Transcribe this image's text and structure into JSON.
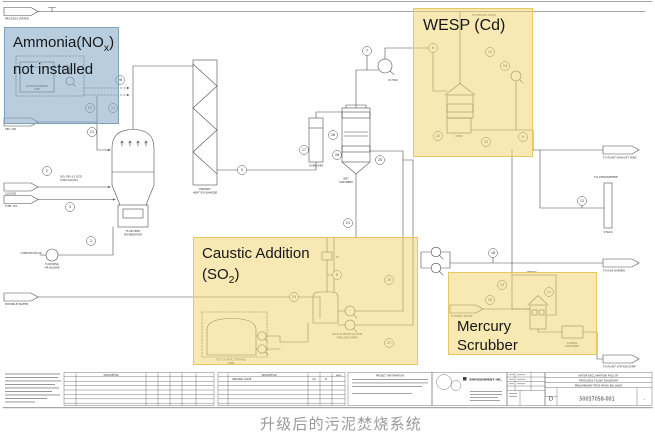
{
  "page": {
    "caption": "升级后的污泥焚烧系统"
  },
  "colors": {
    "highlight_blue": "#7da4c2",
    "highlight_blue_border": "#7fa2bb",
    "highlight_yellow": "#f2d369",
    "highlight_yellow_border": "#e7c763",
    "line": "#4f4f4f"
  },
  "overlays": {
    "ammonia": {
      "line1_main": "Ammonia(NO",
      "line1_sub": "x",
      "line1_close": ")",
      "line2": "not installed"
    },
    "wesp": {
      "label": "WESP (Cd)"
    },
    "caustic": {
      "line1": "Caustic Addition",
      "line2_main": "(SO",
      "line2_sub": "2",
      "line2_close": ")"
    },
    "mercury": {
      "line1": "Mercury",
      "line2": "Scrubber"
    }
  },
  "diagram": {
    "connectors": [
      {
        "label": "PROCESS WATER"
      },
      {
        "label": "SEC AIR"
      },
      {
        "label": "SLUDGE"
      },
      {
        "label": "FUEL OIL"
      },
      {
        "label": "POTABLE WATER"
      },
      {
        "label": "POTABLE WATER"
      },
      {
        "label": "TO PLANT EXHAUST FANS"
      },
      {
        "label": "TO KILN BURNER"
      },
      {
        "label": "TO PLANT STATION SUMP"
      },
      {
        "label": "TO ATMOSPHERE"
      }
    ],
    "labels": {
      "incinerator1": "FLUID BED",
      "incinerator2": "INCINERATOR",
      "hx1": "PRIMARY",
      "hx2": "HEAT EXCHANGER",
      "quencher": "QUENCHER",
      "scrubber1": "WET",
      "scrubber2": "SCRUBBER",
      "id_fan": "ID FAN",
      "wesp": "WESP",
      "stack": "STACK",
      "bypass": "BYPASS",
      "to_exhaust_fan": "TO EXHAUST FAN(S)",
      "combustion_air": "COMBUSTION AIR",
      "blower1": "FLUIDIZING",
      "blower2": "AIR BLOWER",
      "caustic_tank1": "50% CAUSTIC STORAGE",
      "caustic_tank2": "TANK",
      "recirc1": "CAUSTIC RECIRCULATION",
      "recirc2": "TANK AND PUMPS",
      "adsorber1": "CARBON",
      "adsorber2": "ADSORBER",
      "ammonia_tank1": "AQUEOUS AMMONIA",
      "ammonia_tank2": "TANK",
      "sludge_note1": "26% DRY 6.5 DT/D",
      "sludge_note2": "5,800 GAL/DAY",
      "pt": "PT"
    },
    "tags": [
      "7",
      "6",
      "26",
      "27",
      "11",
      "21",
      "2",
      "3",
      "1",
      "5",
      "17",
      "16",
      "26",
      "25",
      "21",
      "10",
      "14",
      "22",
      "15",
      "9",
      "24",
      "8",
      "20",
      "27",
      "18",
      "28",
      "13",
      "11",
      "12"
    ]
  },
  "titleblock": {
    "description_header": "DESCRIPTION",
    "original_issue": "ORIGINAL ISSUE",
    "date_header": "DATE",
    "initials1": "AG",
    "initials2": "LT",
    "project_header": "PROJECT INFORMATION",
    "company": "ENVIRONMENT INC.",
    "facility": "WATER RECLAMATION FACILITY",
    "title1": "PROCESS FLOW DIAGRAM",
    "title2": "PRELIMINARY PFDS MASS BALANCE",
    "size_label": "D",
    "drawing_no": "50037058-001",
    "rev": "-"
  }
}
